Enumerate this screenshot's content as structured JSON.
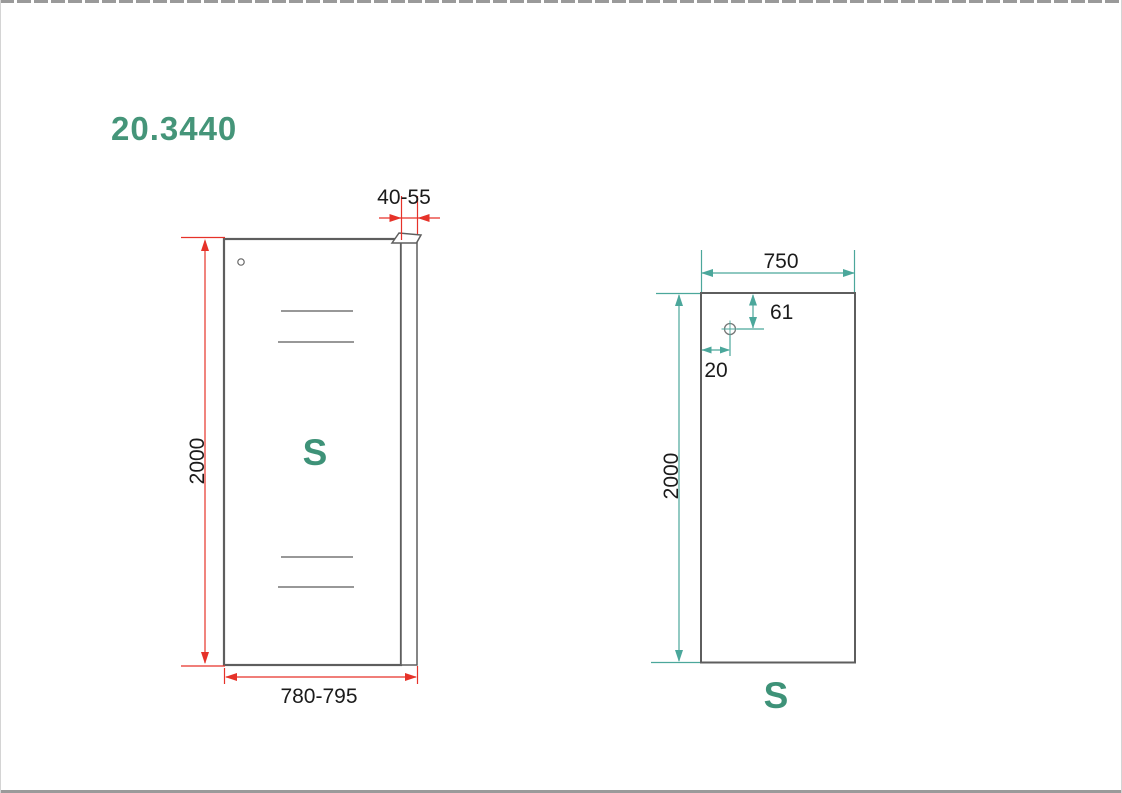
{
  "title": "20.3440",
  "colors": {
    "teal_text": "#3E9278",
    "teal_dimension": "#4BA79B",
    "red_dimension": "#E63229",
    "panel_outline": "#5E5E5E"
  },
  "front_view": {
    "panel_label": "S",
    "dim_profile_width": "40-55",
    "dim_height": "2000",
    "dim_width": "780-795"
  },
  "glass_view": {
    "panel_label": "S",
    "dim_width": "750",
    "dim_height": "2000",
    "dim_hole_top": "61",
    "dim_hole_side": "20"
  }
}
